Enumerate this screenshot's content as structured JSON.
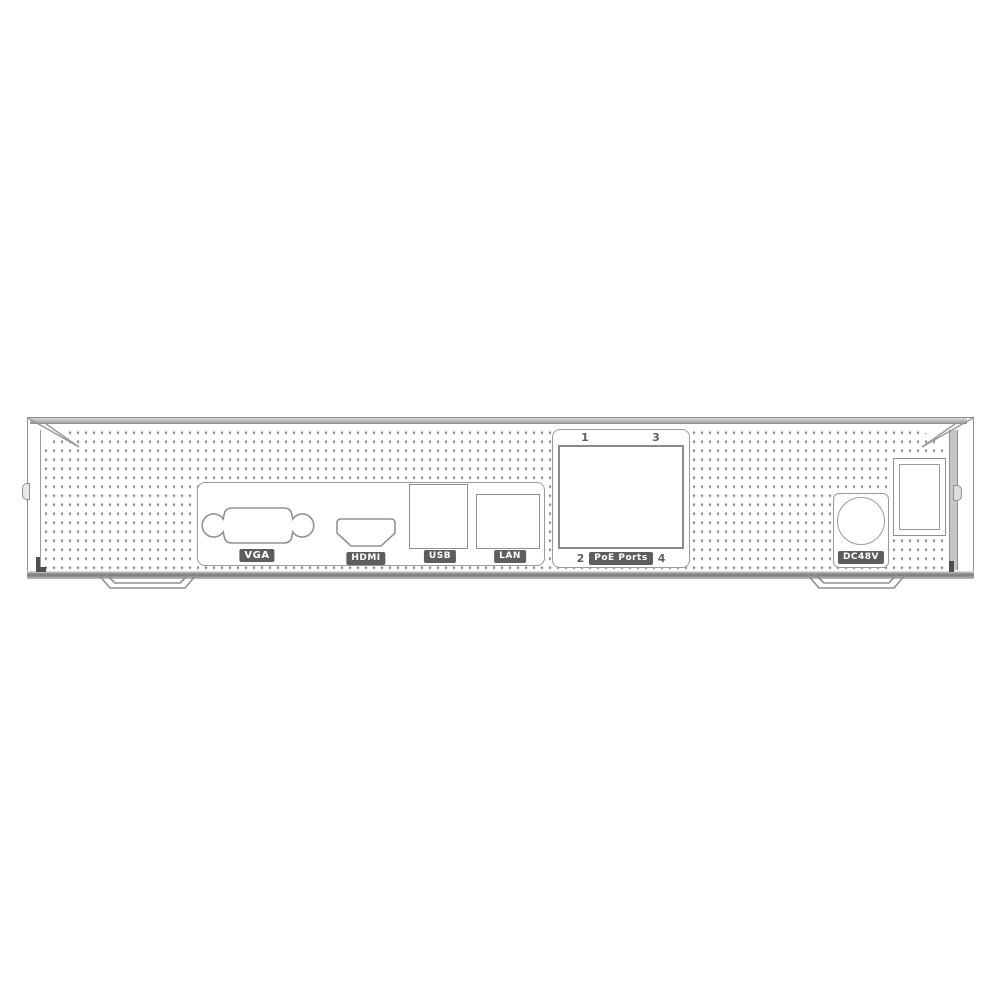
{
  "rear_panel": {
    "io_ports": [
      {
        "id": "vga",
        "label": "VGA"
      },
      {
        "id": "hdmi",
        "label": "HDMI"
      },
      {
        "id": "usb",
        "label": "USB"
      },
      {
        "id": "lan",
        "label": "LAN"
      }
    ],
    "poe_section": {
      "label": "PoE Ports",
      "num_top_left": "1",
      "num_top_right": "3",
      "num_bottom_left": "2",
      "num_bottom_right": "4"
    },
    "power_section": {
      "label": "DC48V"
    }
  },
  "colors": {
    "line": "#8f8f8f",
    "badge_background": "#5e5e5e",
    "badge_text": "#ffffff",
    "dot": "#8d8d8d",
    "number_text": "#5d5d5d",
    "chassis_shadow": "#8a8a8a"
  }
}
